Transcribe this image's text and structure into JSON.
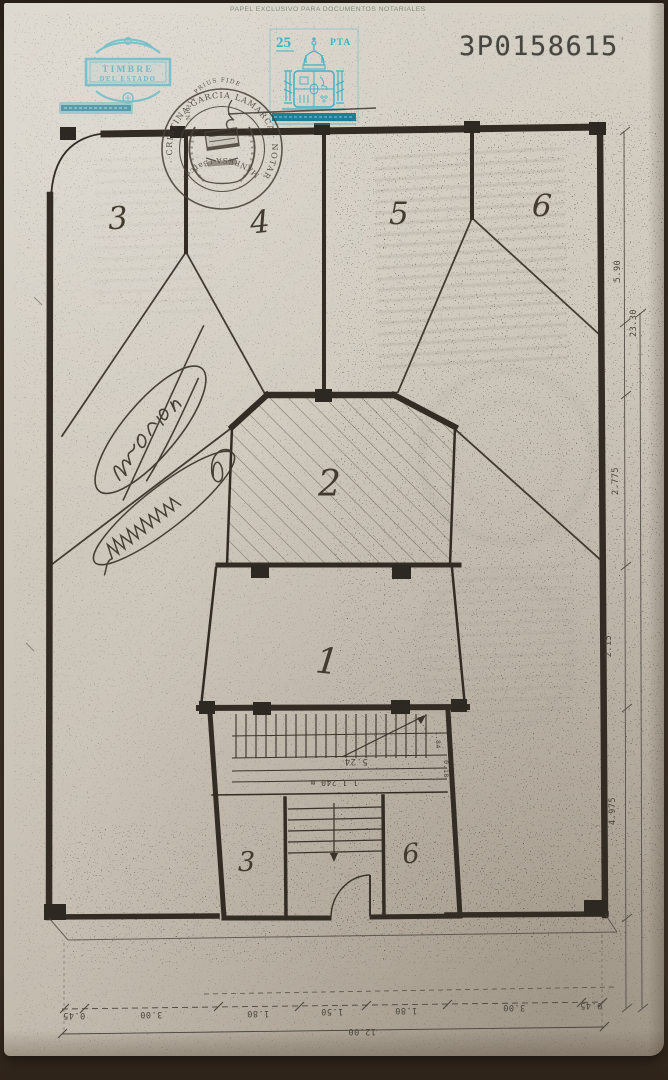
{
  "document": {
    "header_label": "PAPEL EXCLUSIVO PARA DOCUMENTOS NOTARIALES",
    "serial_number": "3P0158615",
    "serial_tick": "'"
  },
  "stamps": {
    "timbre_line1": "TIMBRE",
    "timbre_line2": "DEL ESTADO",
    "tax_value": "25",
    "tax_currency": "PTA"
  },
  "notary_seal": {
    "arc_text": "· CRISTINA GARCIA LAMARCA · NOTARIO ·",
    "bottom_text": "MANRESA (Barcelona)",
    "motto": "NIHIL PRIUS FIDE"
  },
  "floor_plan": {
    "rooms": {
      "top_left": "3",
      "top_center_left": "4",
      "top_center_right": "5",
      "top_right": "6",
      "center_hatched": "2",
      "middle": "1",
      "bottom_left": "3",
      "bottom_right": "6"
    },
    "stair_notes": {
      "note1": "5.24",
      "note2": "1 1.240 m",
      "small1": "1.84",
      "small2": "0.18"
    },
    "dimensions_right": [
      "5.90",
      "23.30",
      "2.775",
      "2.15",
      "4.975"
    ],
    "dimensions_bottom": [
      "0.45",
      "3.00",
      "1.80",
      "1.50",
      "1.80",
      "3.00",
      "0.45"
    ],
    "dimensions_bottom_total": "12.00"
  },
  "colors": {
    "stamp_teal": "#4fb6c6",
    "ink": "#332d26",
    "paper": "#cfc8bc"
  }
}
